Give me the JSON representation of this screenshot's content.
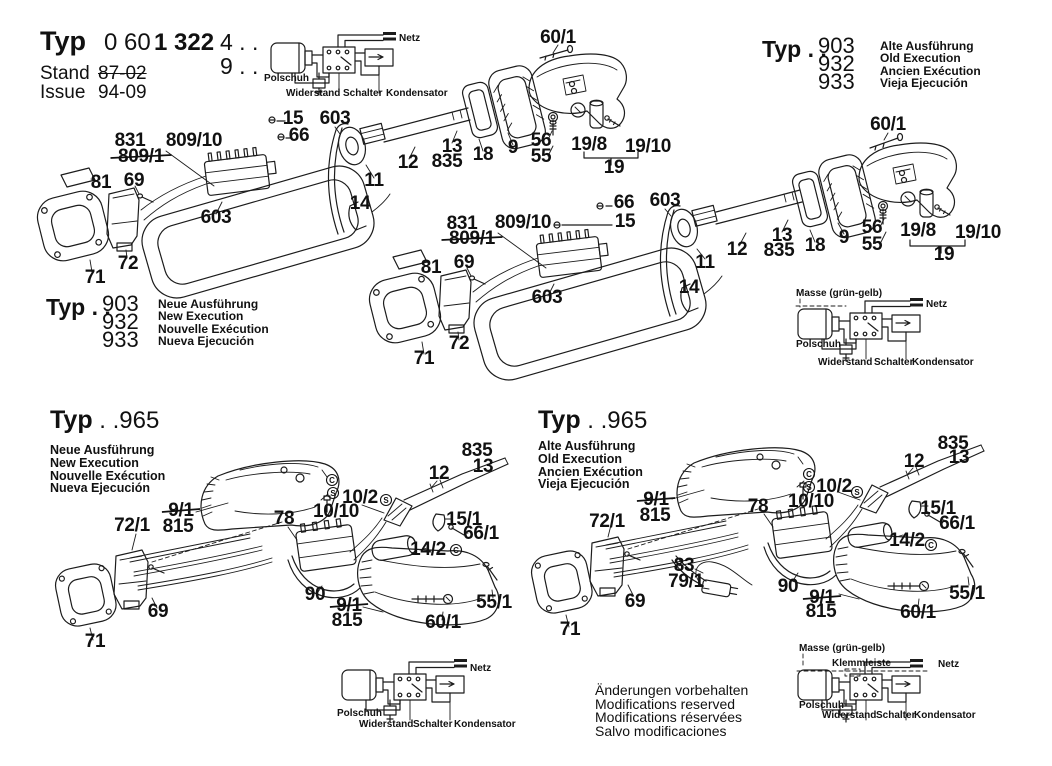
{
  "title_block": {
    "typ_label": "Typ",
    "number_light": "0 60",
    "number_bold": "1 322",
    "suffix_top": "4 . .",
    "suffix_bottom": "9 . .",
    "stand_label": "Stand",
    "stand_value": "87-02",
    "issue_label": "Issue",
    "issue_value": "94-09"
  },
  "typ903_old": {
    "typ": "Typ . .",
    "numbers": [
      "903",
      "932",
      "933"
    ],
    "languages": [
      "Alte Ausführung",
      "Old Execution",
      "Ancien Exécution",
      "Vieja Ejecución"
    ]
  },
  "typ903_new": {
    "typ": "Typ . .",
    "numbers": [
      "903",
      "932",
      "933"
    ],
    "languages": [
      "Neue Ausführung",
      "New Execution",
      "Nouvelle Exécution",
      "Nueva Ejecución"
    ]
  },
  "typ965_new": {
    "typ": "Typ",
    "number": " . .965",
    "languages": [
      "Neue Ausführung",
      "New Execution",
      "Nouvelle Exécution",
      "Nueva Ejecución"
    ]
  },
  "typ965_old": {
    "typ": "Typ",
    "number": " . .965",
    "languages": [
      "Alte Ausführung",
      "Old Execution",
      "Ancien Exécution",
      "Vieja Ejecución"
    ]
  },
  "footer_notes": [
    "Änderungen vorbehalten",
    "Modifications reserved",
    "Modifications réservées",
    "Salvo modificaciones"
  ],
  "colors": {
    "ink": "#111111",
    "line": "#1c1c1c",
    "background": "#ffffff"
  },
  "part_labels": [
    {
      "n": "l-903new-831",
      "t": "831",
      "x": 130,
      "y": 146
    },
    {
      "n": "l-903new-809-1",
      "t": "809/1",
      "x": 141,
      "y": 162,
      "strike": true
    },
    {
      "n": "l-903new-809-10",
      "t": "809/10",
      "x": 194,
      "y": 146
    },
    {
      "n": "l-903new-15",
      "t": "15",
      "x": 293,
      "y": 124
    },
    {
      "n": "l-903new-66",
      "t": "66",
      "x": 299,
      "y": 141
    },
    {
      "n": "l-903new-603a",
      "t": "603",
      "x": 335,
      "y": 124
    },
    {
      "n": "l-903new-81",
      "t": "81",
      "x": 101,
      "y": 188
    },
    {
      "n": "l-903new-69",
      "t": "69",
      "x": 134,
      "y": 186
    },
    {
      "n": "l-903new-603b",
      "t": "603",
      "x": 216,
      "y": 223
    },
    {
      "n": "l-903new-72",
      "t": "72",
      "x": 128,
      "y": 269
    },
    {
      "n": "l-903new-71",
      "t": "71",
      "x": 95,
      "y": 283
    },
    {
      "n": "l-903new-11",
      "t": "11",
      "x": 374,
      "y": 186
    },
    {
      "n": "l-903new-14",
      "t": "14",
      "x": 360,
      "y": 209
    },
    {
      "n": "l-903new-60-1",
      "t": "60/1",
      "x": 558,
      "y": 43
    },
    {
      "n": "l-903new-12",
      "t": "12",
      "x": 408,
      "y": 168
    },
    {
      "n": "l-903new-13",
      "t": "13",
      "x": 452,
      "y": 152
    },
    {
      "n": "l-903new-835",
      "t": "835",
      "x": 447,
      "y": 167
    },
    {
      "n": "l-903new-18",
      "t": "18",
      "x": 483,
      "y": 160
    },
    {
      "n": "l-903new-9",
      "t": "9",
      "x": 513,
      "y": 153
    },
    {
      "n": "l-903new-56",
      "t": "56",
      "x": 541,
      "y": 146
    },
    {
      "n": "l-903new-55",
      "t": "55",
      "x": 541,
      "y": 162
    },
    {
      "n": "l-903new-19-8",
      "t": "19/8",
      "x": 589,
      "y": 150
    },
    {
      "n": "l-903new-19-10",
      "t": "19/10",
      "x": 648,
      "y": 152
    },
    {
      "n": "l-903new-19",
      "t": "19",
      "x": 614,
      "y": 173
    },
    {
      "n": "l-903old-831",
      "t": "831",
      "x": 462,
      "y": 229
    },
    {
      "n": "l-903old-809-1",
      "t": "809/1",
      "x": 472,
      "y": 244,
      "strike": true
    },
    {
      "n": "l-903old-809-10",
      "t": "809/10",
      "x": 523,
      "y": 228
    },
    {
      "n": "l-903old-66",
      "t": "66",
      "x": 624,
      "y": 208
    },
    {
      "n": "l-903old-15",
      "t": "15",
      "x": 625,
      "y": 227
    },
    {
      "n": "l-903old-603a",
      "t": "603",
      "x": 665,
      "y": 206
    },
    {
      "n": "l-903old-81",
      "t": "81",
      "x": 431,
      "y": 273
    },
    {
      "n": "l-903old-69",
      "t": "69",
      "x": 464,
      "y": 268
    },
    {
      "n": "l-903old-603b",
      "t": "603",
      "x": 547,
      "y": 303
    },
    {
      "n": "l-903old-72",
      "t": "72",
      "x": 459,
      "y": 349
    },
    {
      "n": "l-903old-71",
      "t": "71",
      "x": 424,
      "y": 364
    },
    {
      "n": "l-903old-11",
      "t": "11",
      "x": 705,
      "y": 268
    },
    {
      "n": "l-903old-14",
      "t": "14",
      "x": 689,
      "y": 293
    },
    {
      "n": "l-903old-60-1",
      "t": "60/1",
      "x": 888,
      "y": 130
    },
    {
      "n": "l-903old-12",
      "t": "12",
      "x": 737,
      "y": 255
    },
    {
      "n": "l-903old-13",
      "t": "13",
      "x": 782,
      "y": 241
    },
    {
      "n": "l-903old-835",
      "t": "835",
      "x": 779,
      "y": 256
    },
    {
      "n": "l-903old-18",
      "t": "18",
      "x": 815,
      "y": 251
    },
    {
      "n": "l-903old-9",
      "t": "9",
      "x": 844,
      "y": 243
    },
    {
      "n": "l-903old-56",
      "t": "56",
      "x": 872,
      "y": 233
    },
    {
      "n": "l-903old-55",
      "t": "55",
      "x": 872,
      "y": 250
    },
    {
      "n": "l-903old-19-8",
      "t": "19/8",
      "x": 918,
      "y": 236
    },
    {
      "n": "l-903old-19-10",
      "t": "19/10",
      "x": 978,
      "y": 238
    },
    {
      "n": "l-903old-19",
      "t": "19",
      "x": 944,
      "y": 260
    },
    {
      "n": "l-965new-72-1",
      "t": "72/1",
      "x": 132,
      "y": 531
    },
    {
      "n": "l-965new-9-1a",
      "t": "9/1",
      "x": 181,
      "y": 516,
      "strike": true
    },
    {
      "n": "l-965new-815a",
      "t": "815",
      "x": 178,
      "y": 532
    },
    {
      "n": "l-965new-78",
      "t": "78",
      "x": 284,
      "y": 524
    },
    {
      "n": "l-965new-10-2",
      "t": "10/2",
      "x": 360,
      "y": 503
    },
    {
      "n": "l-965new-10-10",
      "t": "10/10",
      "x": 336,
      "y": 517
    },
    {
      "n": "l-965new-12",
      "t": "12",
      "x": 439,
      "y": 479
    },
    {
      "n": "l-965new-835",
      "t": "835",
      "x": 477,
      "y": 456
    },
    {
      "n": "l-965new-13",
      "t": "13",
      "x": 483,
      "y": 472
    },
    {
      "n": "l-965new-15-1",
      "t": "15/1",
      "x": 464,
      "y": 525
    },
    {
      "n": "l-965new-66-1",
      "t": "66/1",
      "x": 481,
      "y": 539
    },
    {
      "n": "l-965new-14-2",
      "t": "14/2",
      "x": 428,
      "y": 555
    },
    {
      "n": "l-965new-90",
      "t": "90",
      "x": 315,
      "y": 600
    },
    {
      "n": "l-965new-9-1b",
      "t": "9/1",
      "x": 349,
      "y": 611,
      "strike": true
    },
    {
      "n": "l-965new-815b",
      "t": "815",
      "x": 347,
      "y": 626
    },
    {
      "n": "l-965new-60-1",
      "t": "60/1",
      "x": 443,
      "y": 628
    },
    {
      "n": "l-965new-55-1",
      "t": "55/1",
      "x": 494,
      "y": 608
    },
    {
      "n": "l-965new-69",
      "t": "69",
      "x": 158,
      "y": 617
    },
    {
      "n": "l-965new-71",
      "t": "71",
      "x": 95,
      "y": 647
    },
    {
      "n": "l-965old-72-1",
      "t": "72/1",
      "x": 607,
      "y": 527
    },
    {
      "n": "l-965old-9-1a",
      "t": "9/1",
      "x": 656,
      "y": 505,
      "strike": true
    },
    {
      "n": "l-965old-815a",
      "t": "815",
      "x": 655,
      "y": 521
    },
    {
      "n": "l-965old-78",
      "t": "78",
      "x": 758,
      "y": 512
    },
    {
      "n": "l-965old-10-2",
      "t": "10/2",
      "x": 834,
      "y": 492
    },
    {
      "n": "l-965old-10-10",
      "t": "10/10",
      "x": 811,
      "y": 507
    },
    {
      "n": "l-965old-12",
      "t": "12",
      "x": 914,
      "y": 467
    },
    {
      "n": "l-965old-835",
      "t": "835",
      "x": 953,
      "y": 449
    },
    {
      "n": "l-965old-13",
      "t": "13",
      "x": 959,
      "y": 463
    },
    {
      "n": "l-965old-15-1",
      "t": "15/1",
      "x": 938,
      "y": 514
    },
    {
      "n": "l-965old-66-1",
      "t": "66/1",
      "x": 957,
      "y": 529
    },
    {
      "n": "l-965old-14-2",
      "t": "14/2",
      "x": 907,
      "y": 546
    },
    {
      "n": "l-965old-83",
      "t": "83",
      "x": 684,
      "y": 571
    },
    {
      "n": "l-965old-79-1",
      "t": "79/1",
      "x": 686,
      "y": 587
    },
    {
      "n": "l-965old-90",
      "t": "90",
      "x": 788,
      "y": 592
    },
    {
      "n": "l-965old-9-1b",
      "t": "9/1",
      "x": 822,
      "y": 603,
      "strike": true
    },
    {
      "n": "l-965old-815b",
      "t": "815",
      "x": 821,
      "y": 617
    },
    {
      "n": "l-965old-60-1",
      "t": "60/1",
      "x": 918,
      "y": 618
    },
    {
      "n": "l-965old-55-1",
      "t": "55/1",
      "x": 967,
      "y": 599
    },
    {
      "n": "l-965old-69",
      "t": "69",
      "x": 635,
      "y": 607
    },
    {
      "n": "l-965old-71",
      "t": "71",
      "x": 570,
      "y": 635
    },
    {
      "n": "w1-netz",
      "t": "Netz",
      "x": 399,
      "y": 41,
      "a": "start",
      "s": 11,
      "cls": "wlabel"
    },
    {
      "n": "w1-polschuh",
      "t": "Polschuh",
      "x": 264,
      "y": 81,
      "a": "start",
      "s": 10,
      "cls": "wlabel"
    },
    {
      "n": "w1-widerstand",
      "t": "Widerstand",
      "x": 286,
      "y": 96,
      "a": "start",
      "s": 10,
      "cls": "wlabel"
    },
    {
      "n": "w1-schalter",
      "t": "Schalter",
      "x": 343,
      "y": 96,
      "a": "start",
      "s": 10,
      "cls": "wlabel"
    },
    {
      "n": "w1-kondensator",
      "t": "Kondensator",
      "x": 386,
      "y": 96,
      "a": "start",
      "s": 10,
      "cls": "wlabel"
    },
    {
      "n": "w2-masse",
      "t": "Masse (grün-gelb)",
      "x": 796,
      "y": 296,
      "a": "start",
      "s": 11,
      "cls": "wlabel"
    },
    {
      "n": "w2-netz",
      "t": "Netz",
      "x": 926,
      "y": 307,
      "a": "start",
      "s": 11,
      "cls": "wlabel"
    },
    {
      "n": "w2-polschuh",
      "t": "Polschuh",
      "x": 796,
      "y": 347,
      "a": "start",
      "s": 10,
      "cls": "wlabel"
    },
    {
      "n": "w2-widerstand",
      "t": "Widerstand",
      "x": 818,
      "y": 365,
      "a": "start",
      "s": 10,
      "cls": "wlabel"
    },
    {
      "n": "w2-schalter",
      "t": "Schalter",
      "x": 874,
      "y": 365,
      "a": "start",
      "s": 10,
      "cls": "wlabel"
    },
    {
      "n": "w2-kondensator",
      "t": "Kondensator",
      "x": 912,
      "y": 365,
      "a": "start",
      "s": 10,
      "cls": "wlabel"
    },
    {
      "n": "w3-netz",
      "t": "Netz",
      "x": 470,
      "y": 671,
      "a": "start",
      "s": 11,
      "cls": "wlabel"
    },
    {
      "n": "w3-polschuh",
      "t": "Polschuh",
      "x": 337,
      "y": 716,
      "a": "start",
      "s": 10,
      "cls": "wlabel"
    },
    {
      "n": "w3-widerstand",
      "t": "Widerstand",
      "x": 359,
      "y": 727,
      "a": "start",
      "s": 10,
      "cls": "wlabel"
    },
    {
      "n": "w3-schalter",
      "t": "Schalter",
      "x": 413,
      "y": 727,
      "a": "start",
      "s": 10,
      "cls": "wlabel"
    },
    {
      "n": "w3-kondensator",
      "t": "Kondensator",
      "x": 454,
      "y": 727,
      "a": "start",
      "s": 10,
      "cls": "wlabel"
    },
    {
      "n": "w4-masse",
      "t": "Masse (grün-gelb)",
      "x": 799,
      "y": 651,
      "a": "start",
      "s": 11,
      "cls": "wlabel"
    },
    {
      "n": "w4-klemmleiste",
      "t": "Klemmleiste",
      "x": 832,
      "y": 666,
      "a": "start",
      "s": 10,
      "cls": "wlabel"
    },
    {
      "n": "w4-netz",
      "t": "Netz",
      "x": 938,
      "y": 667,
      "a": "start",
      "s": 11,
      "cls": "wlabel"
    },
    {
      "n": "w4-polschuh",
      "t": "Polschuh",
      "x": 799,
      "y": 708,
      "a": "start",
      "s": 10,
      "cls": "wlabel"
    },
    {
      "n": "w4-widerstand",
      "t": "Widerstand",
      "x": 822,
      "y": 718,
      "a": "start",
      "s": 10,
      "cls": "wlabel"
    },
    {
      "n": "w4-schalter",
      "t": "Schalter",
      "x": 876,
      "y": 718,
      "a": "start",
      "s": 10,
      "cls": "wlabel"
    },
    {
      "n": "w4-kondensator",
      "t": "Kondensator",
      "x": 914,
      "y": 718,
      "a": "start",
      "s": 10,
      "cls": "wlabel"
    }
  ],
  "marks": [
    {
      "n": "mark-965new-c1",
      "letter": "C",
      "x": 332,
      "y": 480
    },
    {
      "n": "mark-965new-s1",
      "letter": "S",
      "x": 333,
      "y": 493
    },
    {
      "n": "mark-965new-s2",
      "letter": "S",
      "x": 386,
      "y": 500
    },
    {
      "n": "mark-965new-c2",
      "letter": "C",
      "x": 456,
      "y": 550
    },
    {
      "n": "mark-965old-c1",
      "letter": "C",
      "x": 809,
      "y": 474
    },
    {
      "n": "mark-965old-s1",
      "letter": "S",
      "x": 809,
      "y": 487
    },
    {
      "n": "mark-965old-s2",
      "letter": "S",
      "x": 857,
      "y": 492
    },
    {
      "n": "mark-965old-c2",
      "letter": "C",
      "x": 931,
      "y": 545
    }
  ]
}
